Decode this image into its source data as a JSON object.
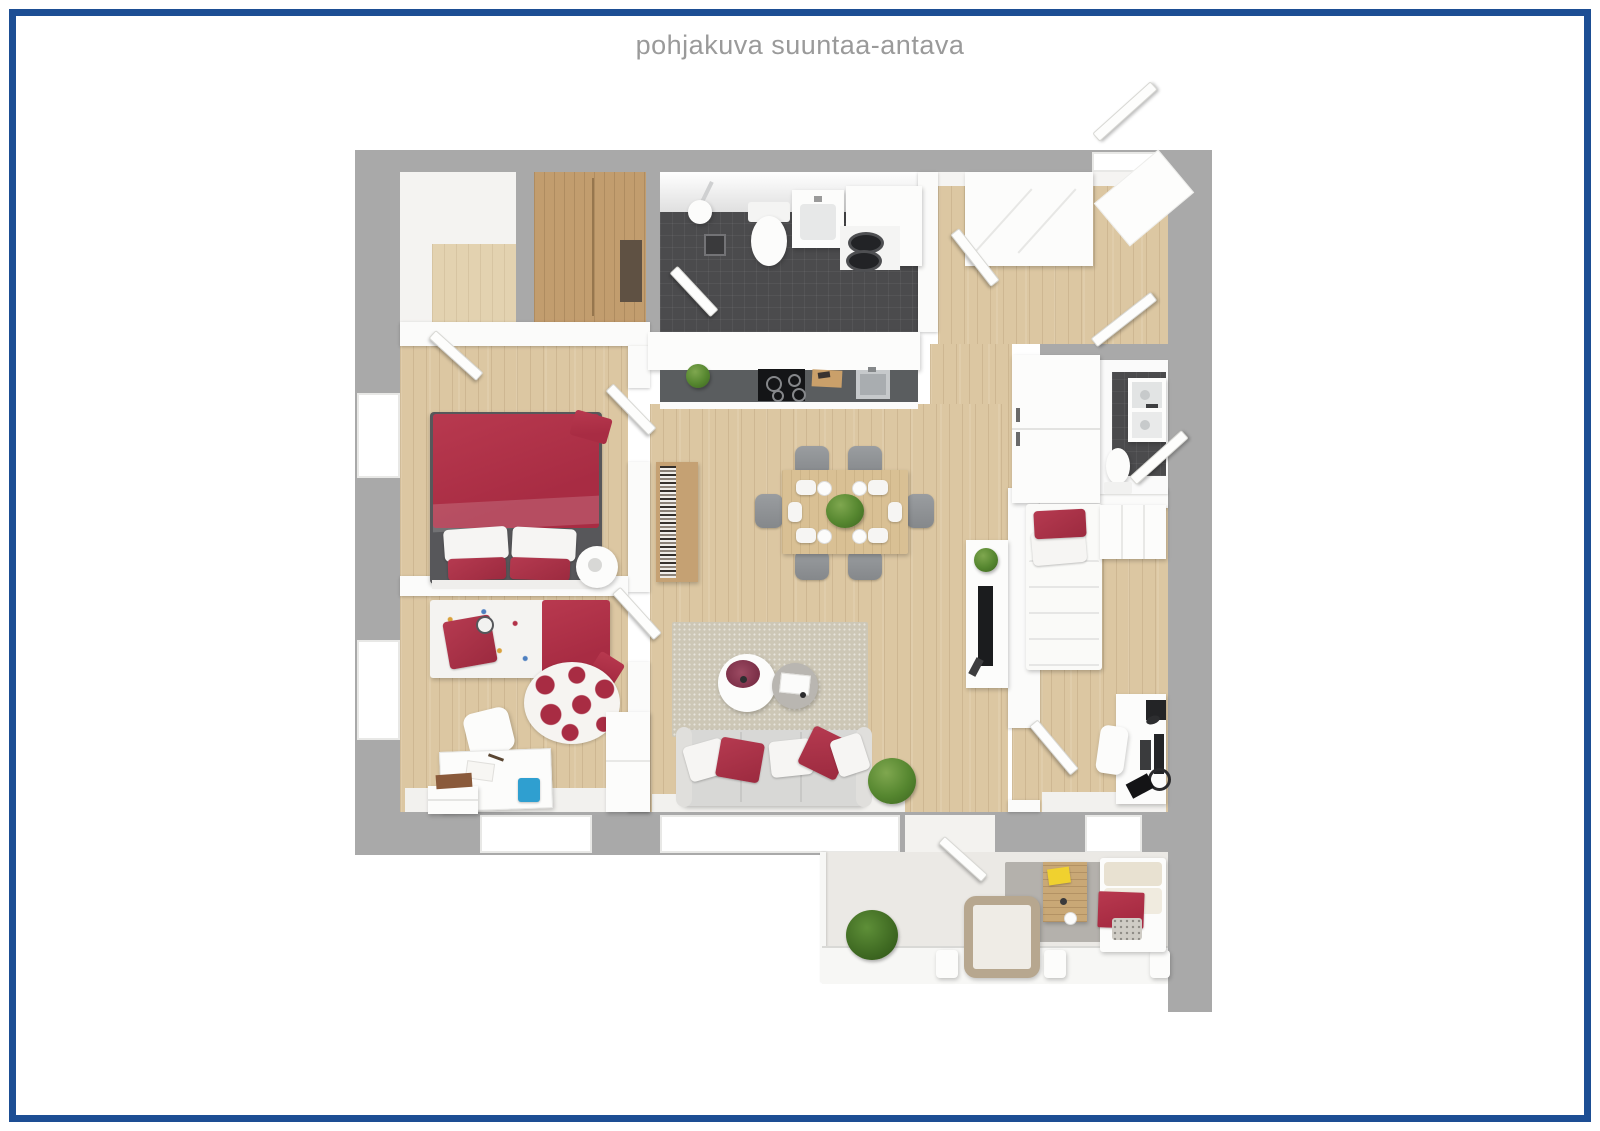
{
  "header": {
    "title": "pohjakuva suuntaa-antava"
  },
  "frame": {
    "border_color": "#1d4e94",
    "background": "#ffffff"
  },
  "palette": {
    "frame_blue": "#1d4e94",
    "title_gray": "#9a9a9a",
    "wall": "#a9a9a9",
    "wood_floor": "#dcc7a2",
    "wood_dark": "#c29d6e",
    "table_wood": "#d9c094",
    "tile_dark": "#4b4b4d",
    "accent_red": "#a82c43",
    "sofa_gray": "#d8d8d6",
    "rug_beige": "#cdc7b6",
    "rug_gray": "#b4b1ac",
    "plant_green": "#55862f",
    "balcony_floor": "#ebe9e5",
    "counter_dark": "#5a5d5f",
    "chair_gray": "#85888b",
    "bin_blue": "#2f9fd0",
    "book_yellow": "#f0d12f"
  }
}
